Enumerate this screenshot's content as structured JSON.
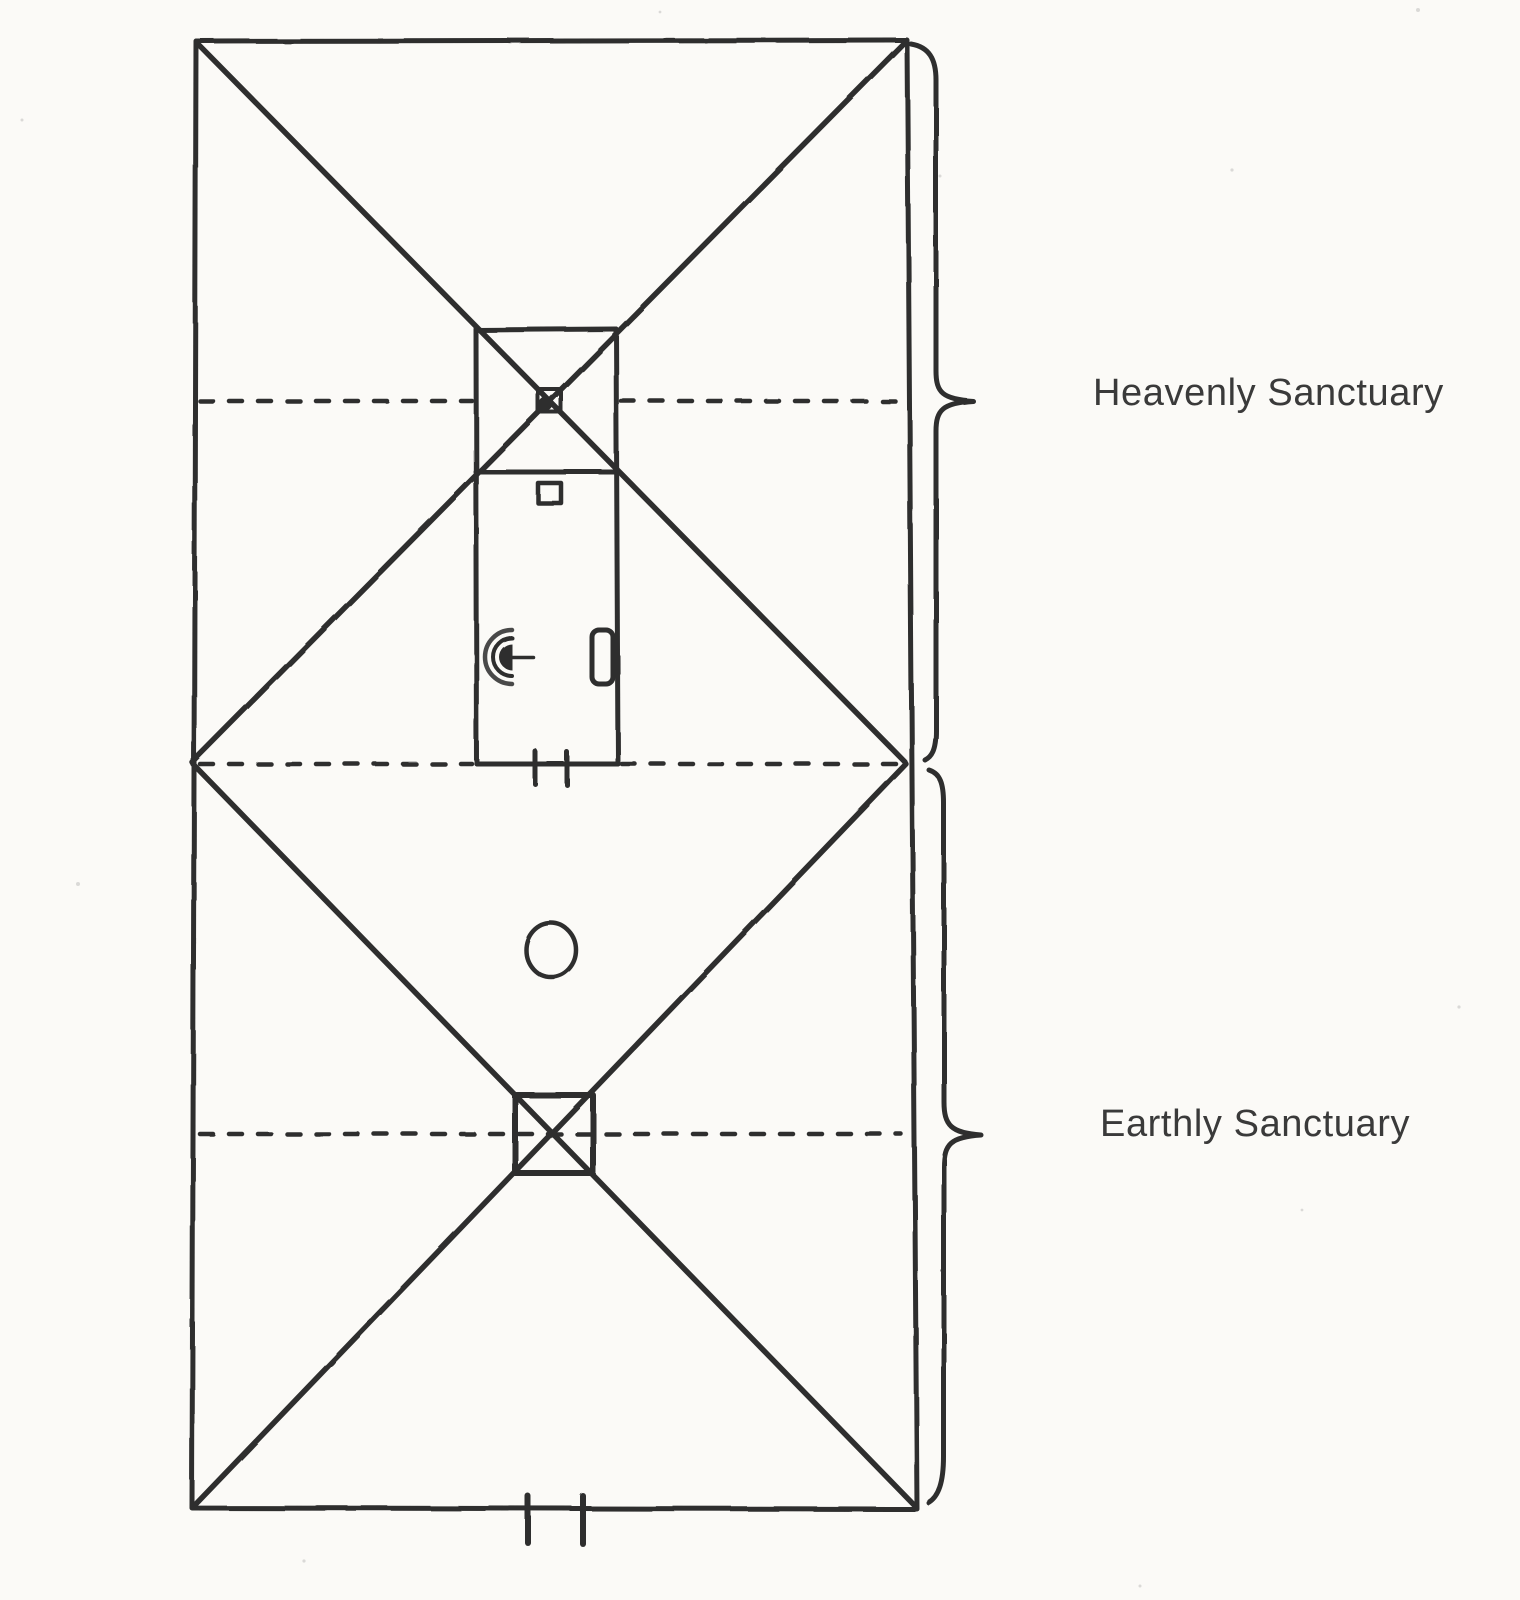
{
  "diagram": {
    "kind": "sanctuary-typology-line-drawing",
    "labels": {
      "heavenly": "Heavenly Sanctuary",
      "earthly": "Earthly Sanctuary"
    },
    "colors": {
      "ink": "#2e2e2e",
      "ink_soft": "#4a4a4a",
      "paper": "#fbfaf7",
      "label_text": "#3a3a3a"
    },
    "icons": [
      "outer-court-rectangle",
      "most-holy-place-room",
      "holy-place-room",
      "ark-marker-icon",
      "incense-altar-icon",
      "lampstand-icon",
      "showbread-table-icon",
      "laver-circle-icon",
      "burnt-offering-altar-icon",
      "veil-entrance-marks-icon",
      "gate-entrance-marks-icon",
      "heavenly-brace-icon",
      "earthly-brace-icon"
    ]
  }
}
